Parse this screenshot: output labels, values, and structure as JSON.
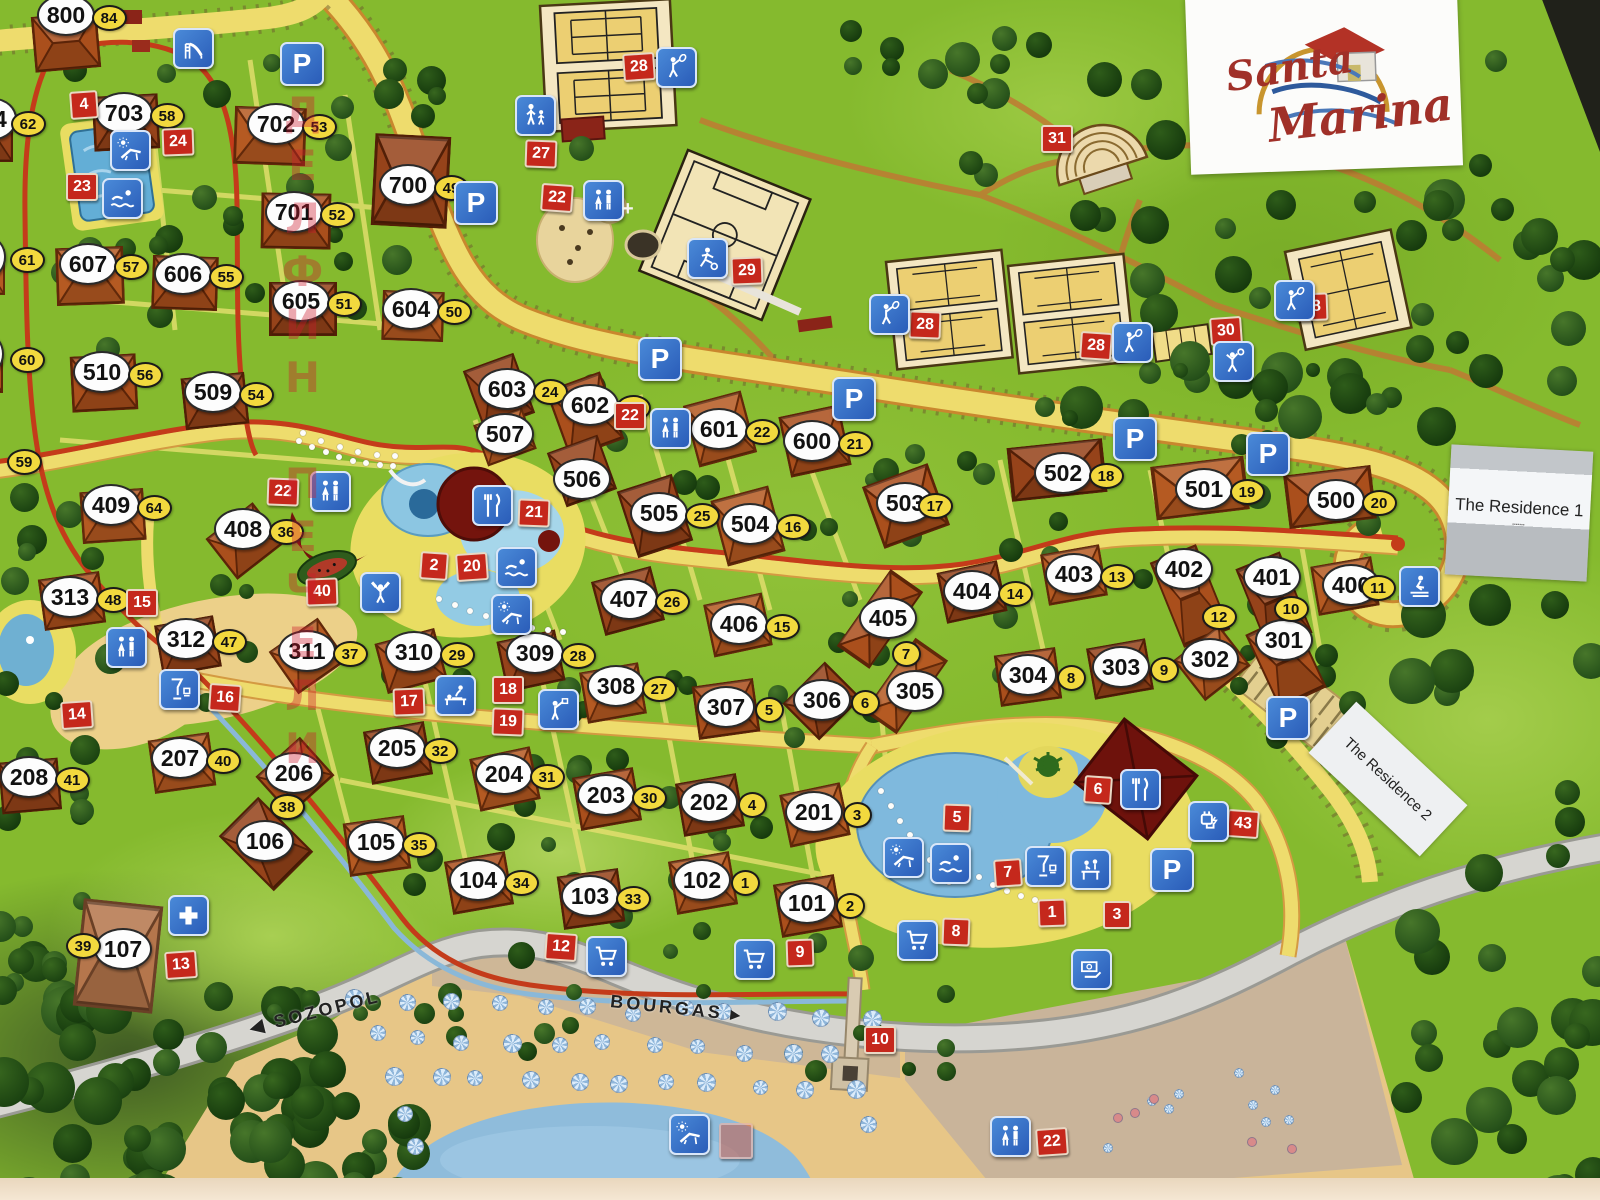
{
  "title": "Santa Marina resort map",
  "logo": {
    "line1": "Santa",
    "line2": "Marina"
  },
  "stickers": {
    "residence1": "The Residence 1",
    "residence2": "The Residence 2"
  },
  "road_labels": {
    "west": "SOZOPOL",
    "west_arrow": "◀",
    "east": "BOURGAS",
    "east_arrow": "▸"
  },
  "watermark": "ДЕЛФИН ПЕЧЕЛИ",
  "colors": {
    "grass": "#85ba2e",
    "tree": "#1d4512",
    "road_yellow": "#eedc6d",
    "road_border": "#c9872e",
    "red_route": "#c43b1a",
    "gray_road": "#d6d5d0",
    "marker_red": "#c5281c",
    "marker_yellow": "#f2d93e",
    "icon_blue": "#2f6cc4",
    "building": "#a84e1e",
    "dark_building": "#6e120c",
    "court": "#f4e7c2",
    "court_inner": "#eccf72",
    "sand": "#e7c687",
    "sea": "#8fbcdb",
    "sticker_gray": "#b8bcc0"
  },
  "buildings": [
    {
      "n": "800",
      "s": "84",
      "x": 64,
      "y": 13,
      "b": {
        "x": 66,
        "y": 42,
        "w": 66,
        "h": 56,
        "r": -5
      }
    },
    {
      "n": "703",
      "s": "58",
      "x": 122,
      "y": 111,
      "b": {
        "x": 126,
        "y": 122,
        "w": 66,
        "h": 55,
        "r": -3
      }
    },
    {
      "n": "702",
      "s": "53",
      "x": 274,
      "y": 122,
      "b": {
        "x": 270,
        "y": 136,
        "w": 72,
        "h": 58,
        "r": 2
      }
    },
    {
      "n": "701",
      "s": "52",
      "x": 292,
      "y": 210,
      "b": {
        "x": 296,
        "y": 221,
        "w": 70,
        "h": 56,
        "r": 1
      }
    },
    {
      "n": "700",
      "s": "49",
      "x": 406,
      "y": 183,
      "b": {
        "x": 411,
        "y": 181,
        "w": 76,
        "h": 92,
        "r": 3
      }
    },
    {
      "n": "607",
      "s": "57",
      "x": 86,
      "y": 262,
      "b": {
        "x": 90,
        "y": 276,
        "w": 68,
        "h": 58,
        "r": -2
      }
    },
    {
      "n": "606",
      "s": "55",
      "x": 181,
      "y": 272,
      "b": {
        "x": 185,
        "y": 283,
        "w": 66,
        "h": 54,
        "r": 2
      }
    },
    {
      "n": "605",
      "s": "51",
      "x": 299,
      "y": 299,
      "b": {
        "x": 303,
        "y": 309,
        "w": 68,
        "h": 54,
        "r": 0
      }
    },
    {
      "n": "604",
      "s": "50",
      "x": 409,
      "y": 307,
      "b": {
        "x": 413,
        "y": 316,
        "w": 62,
        "h": 50,
        "r": 2
      }
    },
    {
      "n": "510",
      "s": "56",
      "x": 100,
      "y": 370,
      "b": {
        "x": 104,
        "y": 383,
        "w": 66,
        "h": 56,
        "r": -3
      }
    },
    {
      "n": "509",
      "s": "54",
      "x": 211,
      "y": 390,
      "b": {
        "x": 215,
        "y": 401,
        "w": 64,
        "h": 52,
        "r": -6
      }
    },
    {
      "n": "409",
      "s": "64",
      "x": 109,
      "y": 503,
      "b": {
        "x": 113,
        "y": 516,
        "w": 64,
        "h": 52,
        "r": -4
      }
    },
    {
      "n": "408",
      "s": "36",
      "x": 241,
      "y": 527,
      "b": {
        "x": 245,
        "y": 541,
        "w": 60,
        "h": 52,
        "r": -38
      }
    },
    {
      "n": "603",
      "s": "24",
      "x": 505,
      "y": 387,
      "b": {
        "x": 499,
        "y": 392,
        "w": 54,
        "h": 64,
        "r": -20
      }
    },
    {
      "n": "507",
      "s": null,
      "x": 503,
      "y": 432,
      "b": {
        "x": 505,
        "y": 437,
        "w": 52,
        "h": 44,
        "r": -20
      }
    },
    {
      "n": "602",
      "s": "23",
      "x": 588,
      "y": 403,
      "b": {
        "x": 585,
        "y": 415,
        "w": 58,
        "h": 72,
        "r": -20
      }
    },
    {
      "n": "506",
      "s": null,
      "x": 580,
      "y": 477,
      "b": {
        "x": 582,
        "y": 471,
        "w": 54,
        "h": 58,
        "r": -20
      }
    },
    {
      "n": "601",
      "s": "22",
      "x": 717,
      "y": 427,
      "b": {
        "x": 720,
        "y": 429,
        "w": 60,
        "h": 64,
        "r": -15
      }
    },
    {
      "n": "600",
      "s": "21",
      "x": 810,
      "y": 439,
      "b": {
        "x": 815,
        "y": 441,
        "w": 62,
        "h": 62,
        "r": -12
      }
    },
    {
      "n": "502",
      "s": "18",
      "x": 1061,
      "y": 471,
      "b": {
        "x": 1057,
        "y": 470,
        "w": 96,
        "h": 54,
        "r": -6
      }
    },
    {
      "n": "501",
      "s": "19",
      "x": 1202,
      "y": 487,
      "b": {
        "x": 1200,
        "y": 488,
        "w": 94,
        "h": 54,
        "r": -7
      }
    },
    {
      "n": "500",
      "s": "20",
      "x": 1334,
      "y": 498,
      "b": {
        "x": 1330,
        "y": 497,
        "w": 88,
        "h": 54,
        "r": -7
      }
    },
    {
      "n": "505",
      "s": "25",
      "x": 657,
      "y": 511,
      "b": {
        "x": 655,
        "y": 516,
        "w": 58,
        "h": 70,
        "r": -18
      }
    },
    {
      "n": "504",
      "s": "16",
      "x": 748,
      "y": 522,
      "b": {
        "x": 748,
        "y": 526,
        "w": 60,
        "h": 68,
        "r": -15
      }
    },
    {
      "n": "503",
      "s": "17",
      "x": 903,
      "y": 501,
      "sdx": 30,
      "b": {
        "x": 906,
        "y": 506,
        "w": 70,
        "h": 66,
        "r": -20
      }
    },
    {
      "n": "407",
      "s": "26",
      "x": 627,
      "y": 597,
      "b": {
        "x": 628,
        "y": 601,
        "w": 62,
        "h": 56,
        "r": -15
      }
    },
    {
      "n": "406",
      "s": "15",
      "x": 737,
      "y": 622,
      "b": {
        "x": 738,
        "y": 625,
        "w": 60,
        "h": 54,
        "r": -12
      }
    },
    {
      "n": "405",
      "s": null,
      "x": 886,
      "y": 616,
      "b": {
        "x": 880,
        "y": 619,
        "w": 94,
        "h": 40,
        "r": -55
      }
    },
    {
      "n": "404",
      "s": "14",
      "x": 970,
      "y": 589,
      "b": {
        "x": 972,
        "y": 592,
        "w": 62,
        "h": 52,
        "r": -12
      }
    },
    {
      "n": "403",
      "s": "13",
      "x": 1072,
      "y": 572,
      "b": {
        "x": 1074,
        "y": 575,
        "w": 60,
        "h": 52,
        "r": -10
      }
    },
    {
      "n": "402",
      "s": null,
      "x": 1182,
      "y": 567,
      "b": {
        "x": 1190,
        "y": 596,
        "w": 50,
        "h": 92,
        "r": -22
      }
    },
    {
      "n": "401",
      "s": null,
      "x": 1270,
      "y": 575,
      "b": {
        "x": 1274,
        "y": 601,
        "w": 48,
        "h": 88,
        "r": -22
      }
    },
    {
      "n": "400",
      "s": "11",
      "x": 1349,
      "y": 583,
      "sdx": 27,
      "b": {
        "x": 1345,
        "y": 586,
        "w": 62,
        "h": 50,
        "r": -10
      }
    },
    {
      "n": "313",
      "s": "48",
      "x": 68,
      "y": 595,
      "b": {
        "x": 72,
        "y": 601,
        "w": 62,
        "h": 52,
        "r": -8
      }
    },
    {
      "n": "312",
      "s": "47",
      "x": 184,
      "y": 637,
      "b": {
        "x": 188,
        "y": 646,
        "w": 60,
        "h": 52,
        "r": -10
      }
    },
    {
      "n": "311",
      "s": "37",
      "x": 305,
      "y": 649,
      "b": {
        "x": 308,
        "y": 656,
        "w": 60,
        "h": 52,
        "r": -35
      }
    },
    {
      "n": "310",
      "s": "29",
      "x": 412,
      "y": 650,
      "b": {
        "x": 411,
        "y": 661,
        "w": 62,
        "h": 52,
        "r": -15
      }
    },
    {
      "n": "309",
      "s": "28",
      "x": 533,
      "y": 651,
      "b": {
        "x": 531,
        "y": 661,
        "w": 60,
        "h": 52,
        "r": -12
      }
    },
    {
      "n": "308",
      "s": "27",
      "x": 614,
      "y": 684,
      "b": {
        "x": 613,
        "y": 693,
        "w": 60,
        "h": 52,
        "r": -10
      }
    },
    {
      "n": "307",
      "s": "5",
      "x": 724,
      "y": 705,
      "b": {
        "x": 726,
        "y": 709,
        "w": 62,
        "h": 54,
        "r": -8
      }
    },
    {
      "n": "306",
      "s": "6",
      "x": 820,
      "y": 698,
      "b": {
        "x": 822,
        "y": 701,
        "w": 60,
        "h": 52,
        "r": -45
      }
    },
    {
      "n": "305",
      "s": null,
      "x": 913,
      "y": 689,
      "b": {
        "x": 906,
        "y": 686,
        "w": 90,
        "h": 40,
        "r": -55
      }
    },
    {
      "n": "304",
      "s": "8",
      "x": 1026,
      "y": 673,
      "b": {
        "x": 1028,
        "y": 677,
        "w": 62,
        "h": 52,
        "r": -8
      }
    },
    {
      "n": "303",
      "s": "9",
      "x": 1119,
      "y": 665,
      "b": {
        "x": 1120,
        "y": 669,
        "w": 60,
        "h": 52,
        "r": -10
      }
    },
    {
      "n": "302",
      "s": null,
      "x": 1208,
      "y": 657,
      "b": {
        "x": 1212,
        "y": 663,
        "w": 58,
        "h": 52,
        "r": -38
      }
    },
    {
      "n": "301",
      "s": null,
      "x": 1282,
      "y": 638,
      "b": {
        "x": 1286,
        "y": 661,
        "w": 52,
        "h": 82,
        "r": -25
      }
    },
    {
      "n": "208",
      "s": "41",
      "x": 27,
      "y": 775,
      "b": {
        "x": 30,
        "y": 786,
        "w": 60,
        "h": 52,
        "r": -5
      }
    },
    {
      "n": "207",
      "s": "40",
      "x": 178,
      "y": 756,
      "b": {
        "x": 182,
        "y": 763,
        "w": 62,
        "h": 54,
        "r": -8
      }
    },
    {
      "n": "206",
      "s": "38",
      "x": 292,
      "y": 771,
      "sdx": -7,
      "sdy": 34,
      "b": {
        "x": 295,
        "y": 776,
        "w": 60,
        "h": 52,
        "r": -42
      }
    },
    {
      "n": "205",
      "s": "32",
      "x": 395,
      "y": 746,
      "b": {
        "x": 398,
        "y": 753,
        "w": 62,
        "h": 54,
        "r": -10
      }
    },
    {
      "n": "204",
      "s": "31",
      "x": 502,
      "y": 772,
      "b": {
        "x": 505,
        "y": 779,
        "w": 62,
        "h": 54,
        "r": -12
      }
    },
    {
      "n": "203",
      "s": "30",
      "x": 604,
      "y": 793,
      "b": {
        "x": 607,
        "y": 799,
        "w": 62,
        "h": 54,
        "r": -10
      }
    },
    {
      "n": "202",
      "s": "4",
      "x": 707,
      "y": 800,
      "b": {
        "x": 710,
        "y": 805,
        "w": 62,
        "h": 54,
        "r": -10
      }
    },
    {
      "n": "201",
      "s": "3",
      "x": 812,
      "y": 810,
      "b": {
        "x": 815,
        "y": 815,
        "w": 62,
        "h": 54,
        "r": -12
      }
    },
    {
      "n": "107",
      "s": "39",
      "x": 121,
      "y": 947,
      "sdx": -40,
      "sdy": -3,
      "v": 3,
      "b": {
        "x": 118,
        "y": 956,
        "w": 80,
        "h": 108,
        "r": 6
      }
    },
    {
      "n": "106",
      "s": null,
      "x": 263,
      "y": 839,
      "b": {
        "x": 266,
        "y": 844,
        "w": 56,
        "h": 78,
        "r": -45
      }
    },
    {
      "n": "105",
      "s": "35",
      "x": 374,
      "y": 840,
      "b": {
        "x": 377,
        "y": 846,
        "w": 62,
        "h": 54,
        "r": -8
      }
    },
    {
      "n": "104",
      "s": "34",
      "x": 476,
      "y": 878,
      "b": {
        "x": 479,
        "y": 883,
        "w": 62,
        "h": 54,
        "r": -10
      }
    },
    {
      "n": "103",
      "s": "33",
      "x": 588,
      "y": 894,
      "b": {
        "x": 591,
        "y": 899,
        "w": 62,
        "h": 54,
        "r": -8
      }
    },
    {
      "n": "102",
      "s": "1",
      "x": 700,
      "y": 878,
      "b": {
        "x": 703,
        "y": 883,
        "w": 62,
        "h": 54,
        "r": -10
      }
    },
    {
      "n": "101",
      "s": "2",
      "x": 805,
      "y": 901,
      "b": {
        "x": 808,
        "y": 906,
        "w": 62,
        "h": 54,
        "r": -10
      }
    },
    {
      "n": "04",
      "s": "62",
      "x": -8,
      "y": 117,
      "sdx": 34,
      "sdy": 5,
      "b": {
        "x": -14,
        "y": 138,
        "w": 54,
        "h": 48,
        "r": 0
      }
    },
    {
      "n": "8",
      "s": "61",
      "x": -14,
      "y": 255,
      "sdx": 39,
      "b": {
        "x": -20,
        "y": 272,
        "w": 50,
        "h": 46,
        "r": 0
      }
    },
    {
      "n": "0",
      "s": "60",
      "x": -16,
      "y": 352,
      "sdx": 41,
      "sdy": 6,
      "b": {
        "x": -22,
        "y": 370,
        "w": 50,
        "h": 46,
        "r": 0
      }
    }
  ],
  "red_markers": [
    {
      "n": "4",
      "x": 82,
      "y": 103
    },
    {
      "n": "24",
      "x": 176,
      "y": 140
    },
    {
      "n": "23",
      "x": 80,
      "y": 185
    },
    {
      "n": "27",
      "x": 539,
      "y": 152
    },
    {
      "n": "22",
      "x": 555,
      "y": 196
    },
    {
      "n": "28",
      "x": 637,
      "y": 65
    },
    {
      "n": "29",
      "x": 745,
      "y": 269
    },
    {
      "n": "31",
      "x": 1055,
      "y": 137
    },
    {
      "n": "28",
      "x": 923,
      "y": 323
    },
    {
      "n": "28",
      "x": 1094,
      "y": 344
    },
    {
      "n": "30",
      "x": 1224,
      "y": 329
    },
    {
      "n": "28",
      "x": 1310,
      "y": 305
    },
    {
      "n": "22",
      "x": 628,
      "y": 414
    },
    {
      "n": "21",
      "x": 532,
      "y": 511
    },
    {
      "n": "2",
      "x": 432,
      "y": 564
    },
    {
      "n": "20",
      "x": 470,
      "y": 565
    },
    {
      "n": "40",
      "x": 320,
      "y": 590
    },
    {
      "n": "15",
      "x": 140,
      "y": 601
    },
    {
      "n": "22",
      "x": 281,
      "y": 490
    },
    {
      "n": "16",
      "x": 223,
      "y": 696
    },
    {
      "n": "14",
      "x": 75,
      "y": 713
    },
    {
      "n": "17",
      "x": 407,
      "y": 700
    },
    {
      "n": "18",
      "x": 506,
      "y": 688
    },
    {
      "n": "19",
      "x": 506,
      "y": 720
    },
    {
      "n": "12",
      "x": 559,
      "y": 945
    },
    {
      "n": "13",
      "x": 179,
      "y": 963
    },
    {
      "n": "9",
      "x": 798,
      "y": 951
    },
    {
      "n": "10",
      "x": 878,
      "y": 1038
    },
    {
      "n": "5",
      "x": 955,
      "y": 816
    },
    {
      "n": "6",
      "x": 1096,
      "y": 788
    },
    {
      "n": "7",
      "x": 1006,
      "y": 871
    },
    {
      "n": "1",
      "x": 1050,
      "y": 911
    },
    {
      "n": "3",
      "x": 1115,
      "y": 913
    },
    {
      "n": "8",
      "x": 954,
      "y": 930
    },
    {
      "n": "43",
      "x": 1241,
      "y": 822
    },
    {
      "n": "22",
      "x": 1050,
      "y": 1140
    }
  ],
  "yellow_markers": [
    {
      "n": "59",
      "x": 22,
      "y": 460
    },
    {
      "n": "38",
      "x": 285,
      "y": 805
    },
    {
      "n": "7",
      "x": 904,
      "y": 652
    },
    {
      "n": "12",
      "x": 1217,
      "y": 615
    },
    {
      "n": "10",
      "x": 1289,
      "y": 607
    }
  ],
  "icons": [
    {
      "t": "parking",
      "x": 300,
      "y": 62
    },
    {
      "t": "parking",
      "x": 474,
      "y": 201
    },
    {
      "t": "parking",
      "x": 658,
      "y": 357
    },
    {
      "t": "parking",
      "x": 852,
      "y": 397
    },
    {
      "t": "parking",
      "x": 1133,
      "y": 437
    },
    {
      "t": "parking",
      "x": 1266,
      "y": 452
    },
    {
      "t": "parking",
      "x": 1170,
      "y": 868
    },
    {
      "t": "parking",
      "x": 1286,
      "y": 716
    },
    {
      "t": "wc",
      "x": 601,
      "y": 198
    },
    {
      "t": "wc",
      "x": 668,
      "y": 426
    },
    {
      "t": "wc",
      "x": 328,
      "y": 489
    },
    {
      "t": "wc",
      "x": 124,
      "y": 645
    },
    {
      "t": "wc",
      "x": 1008,
      "y": 1134
    },
    {
      "t": "playground",
      "x": 191,
      "y": 46
    },
    {
      "t": "parentchild",
      "x": 533,
      "y": 113
    },
    {
      "t": "tennis",
      "x": 674,
      "y": 65
    },
    {
      "t": "tennis",
      "x": 887,
      "y": 312
    },
    {
      "t": "tennis",
      "x": 1130,
      "y": 340
    },
    {
      "t": "tennis",
      "x": 1292,
      "y": 298
    },
    {
      "t": "volleyball",
      "x": 1231,
      "y": 359
    },
    {
      "t": "soccer",
      "x": 705,
      "y": 256
    },
    {
      "t": "fitness",
      "x": 378,
      "y": 590
    },
    {
      "t": "swim",
      "x": 120,
      "y": 196
    },
    {
      "t": "swim",
      "x": 514,
      "y": 565
    },
    {
      "t": "swim",
      "x": 948,
      "y": 861
    },
    {
      "t": "lounger",
      "x": 128,
      "y": 148
    },
    {
      "t": "lounger",
      "x": 509,
      "y": 612
    },
    {
      "t": "lounger",
      "x": 901,
      "y": 855
    },
    {
      "t": "lounger",
      "x": 687,
      "y": 1132
    },
    {
      "t": "restaurant",
      "x": 490,
      "y": 503
    },
    {
      "t": "restaurant",
      "x": 1138,
      "y": 787
    },
    {
      "t": "bar",
      "x": 177,
      "y": 687
    },
    {
      "t": "bar",
      "x": 1043,
      "y": 864
    },
    {
      "t": "massage",
      "x": 453,
      "y": 693
    },
    {
      "t": "games",
      "x": 556,
      "y": 707
    },
    {
      "t": "reception",
      "x": 1088,
      "y": 867
    },
    {
      "t": "cart",
      "x": 604,
      "y": 954
    },
    {
      "t": "cart",
      "x": 752,
      "y": 957
    },
    {
      "t": "cart",
      "x": 915,
      "y": 938
    },
    {
      "t": "medic",
      "x": 186,
      "y": 913
    },
    {
      "t": "ev",
      "x": 1206,
      "y": 819
    },
    {
      "t": "exchange",
      "x": 1089,
      "y": 967
    },
    {
      "t": "waterski",
      "x": 1417,
      "y": 584
    }
  ]
}
